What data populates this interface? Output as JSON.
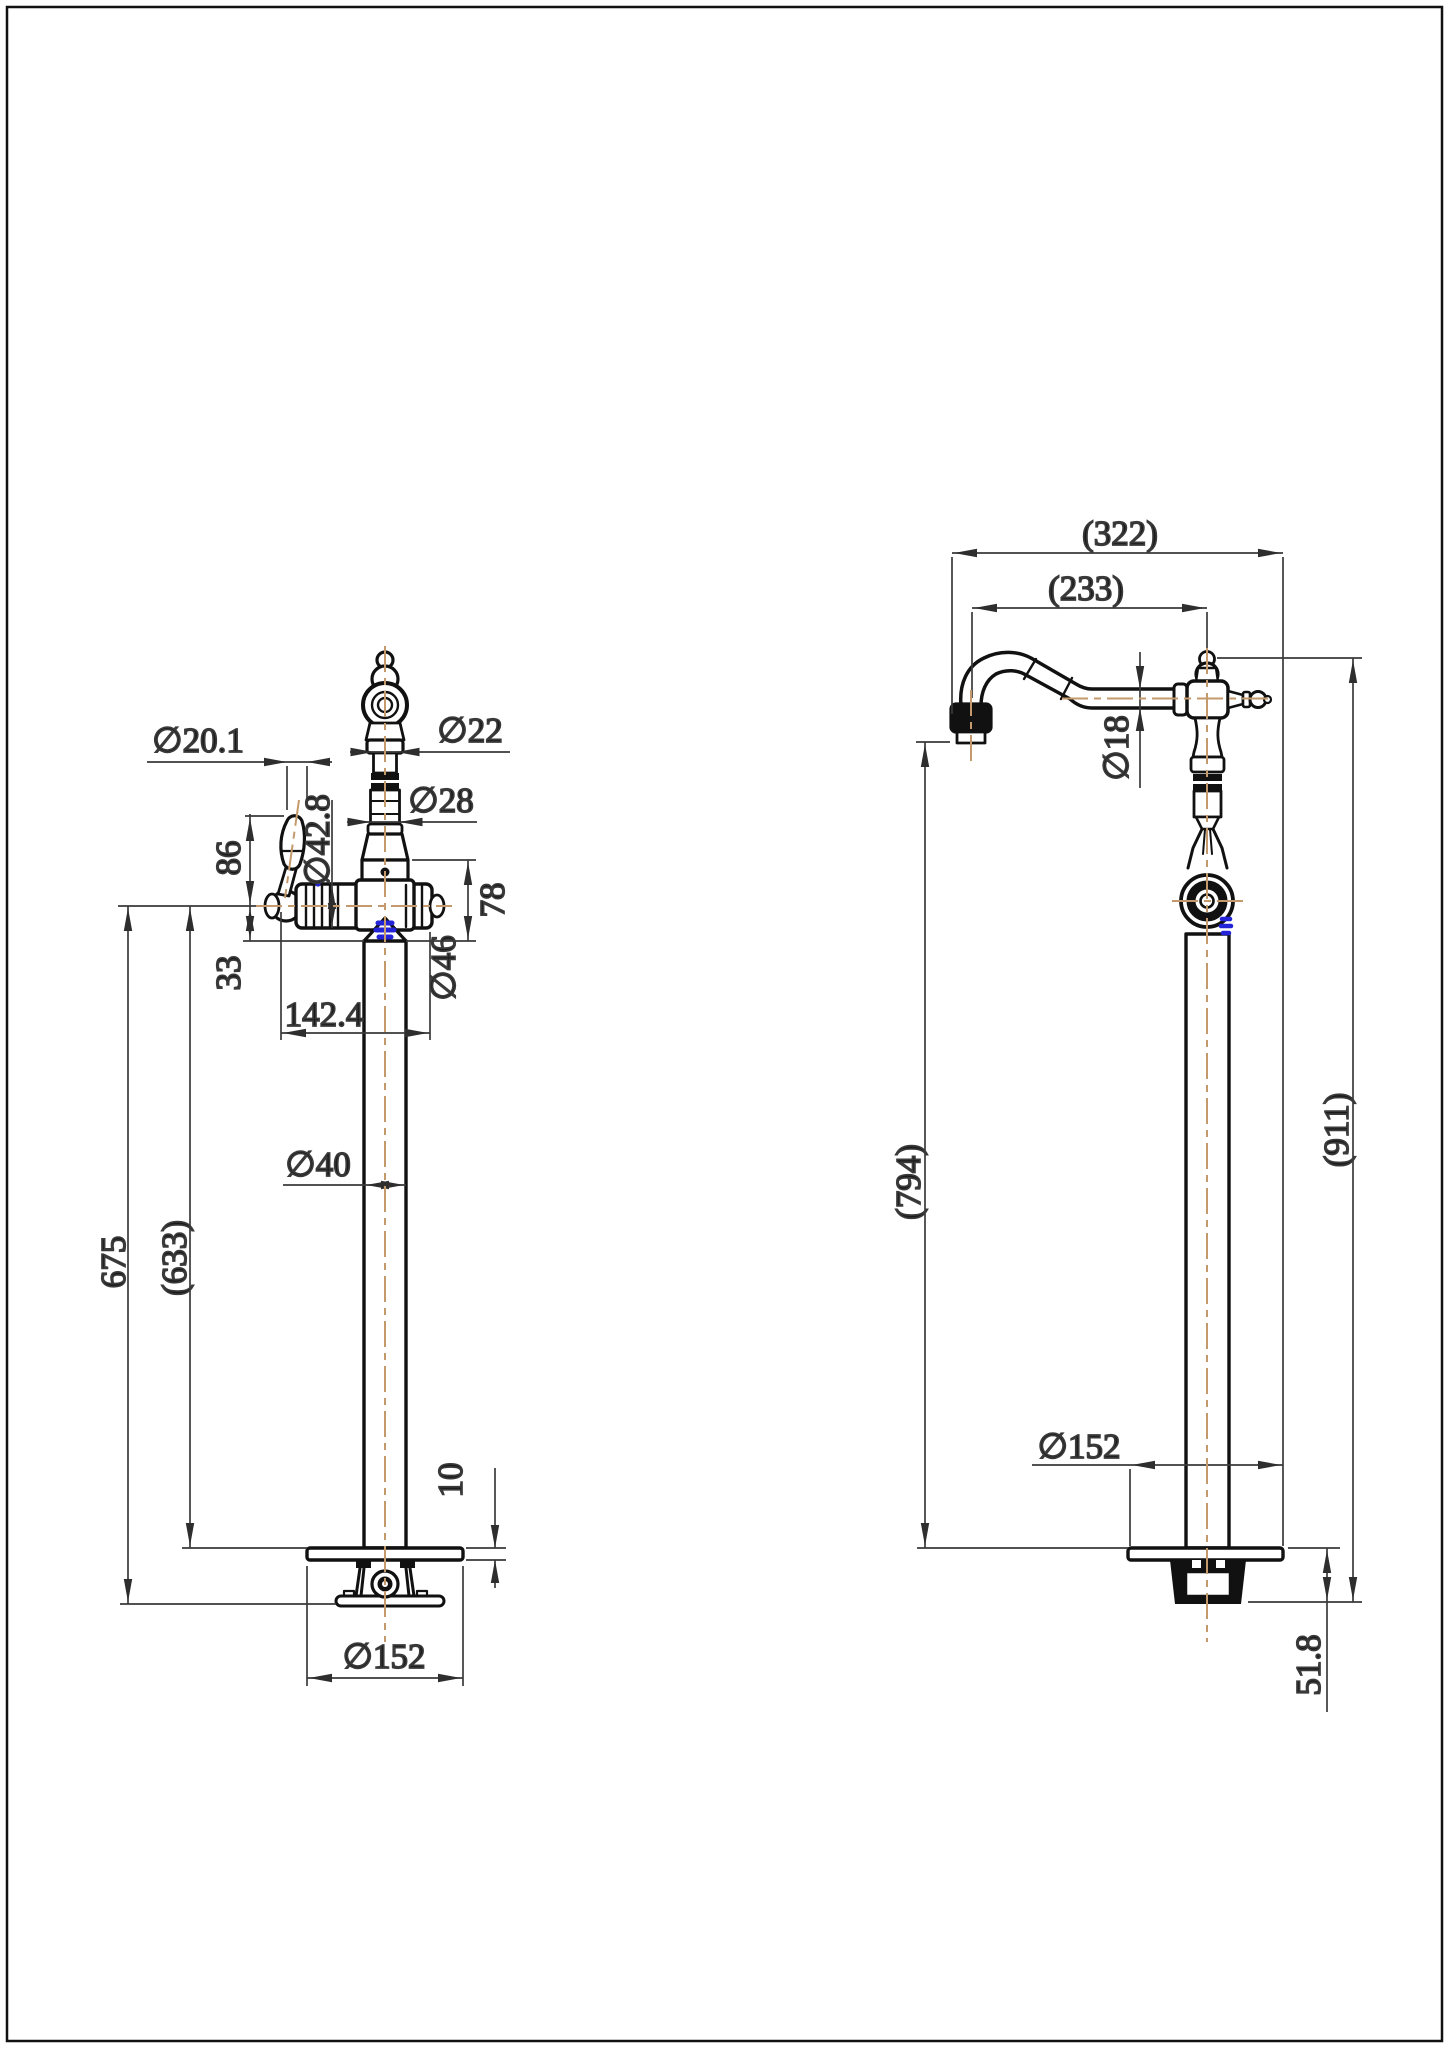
{
  "drawing": {
    "type": "technical-dimension-drawing",
    "subject": "freestanding bath filler tap, two orthographic views",
    "colors": {
      "outline": "#111111",
      "dimension_lines": "#3a3a3a",
      "centerline": "#C49A6C",
      "highlight": "#2323d8",
      "background": "#ffffff"
    },
    "diameter_symbol": "∅",
    "front_view": {
      "dia_handle_lever": "∅20.1",
      "dia_spout_top": "∅22",
      "dia_riser": "∅28",
      "dia_body": "∅42.8",
      "handle_height": "86",
      "body_section_height": "78",
      "below_center": "33",
      "handle_reach": "142.4",
      "dia_end_cap": "∅46",
      "dia_column": "∅40",
      "height_floor_to_center": "675",
      "height_floor_to_plate": "(633)",
      "plate_thickness": "10",
      "dia_base_plate": "∅152"
    },
    "side_view": {
      "spout_reach_overall": "(322)",
      "spout_reach_to_axis": "(233)",
      "dia_spout_pipe": "∅18",
      "height_to_outlet": "(794)",
      "height_overall": "(911)",
      "dia_base_plate": "∅152",
      "base_assembly_height": "51.8"
    }
  }
}
